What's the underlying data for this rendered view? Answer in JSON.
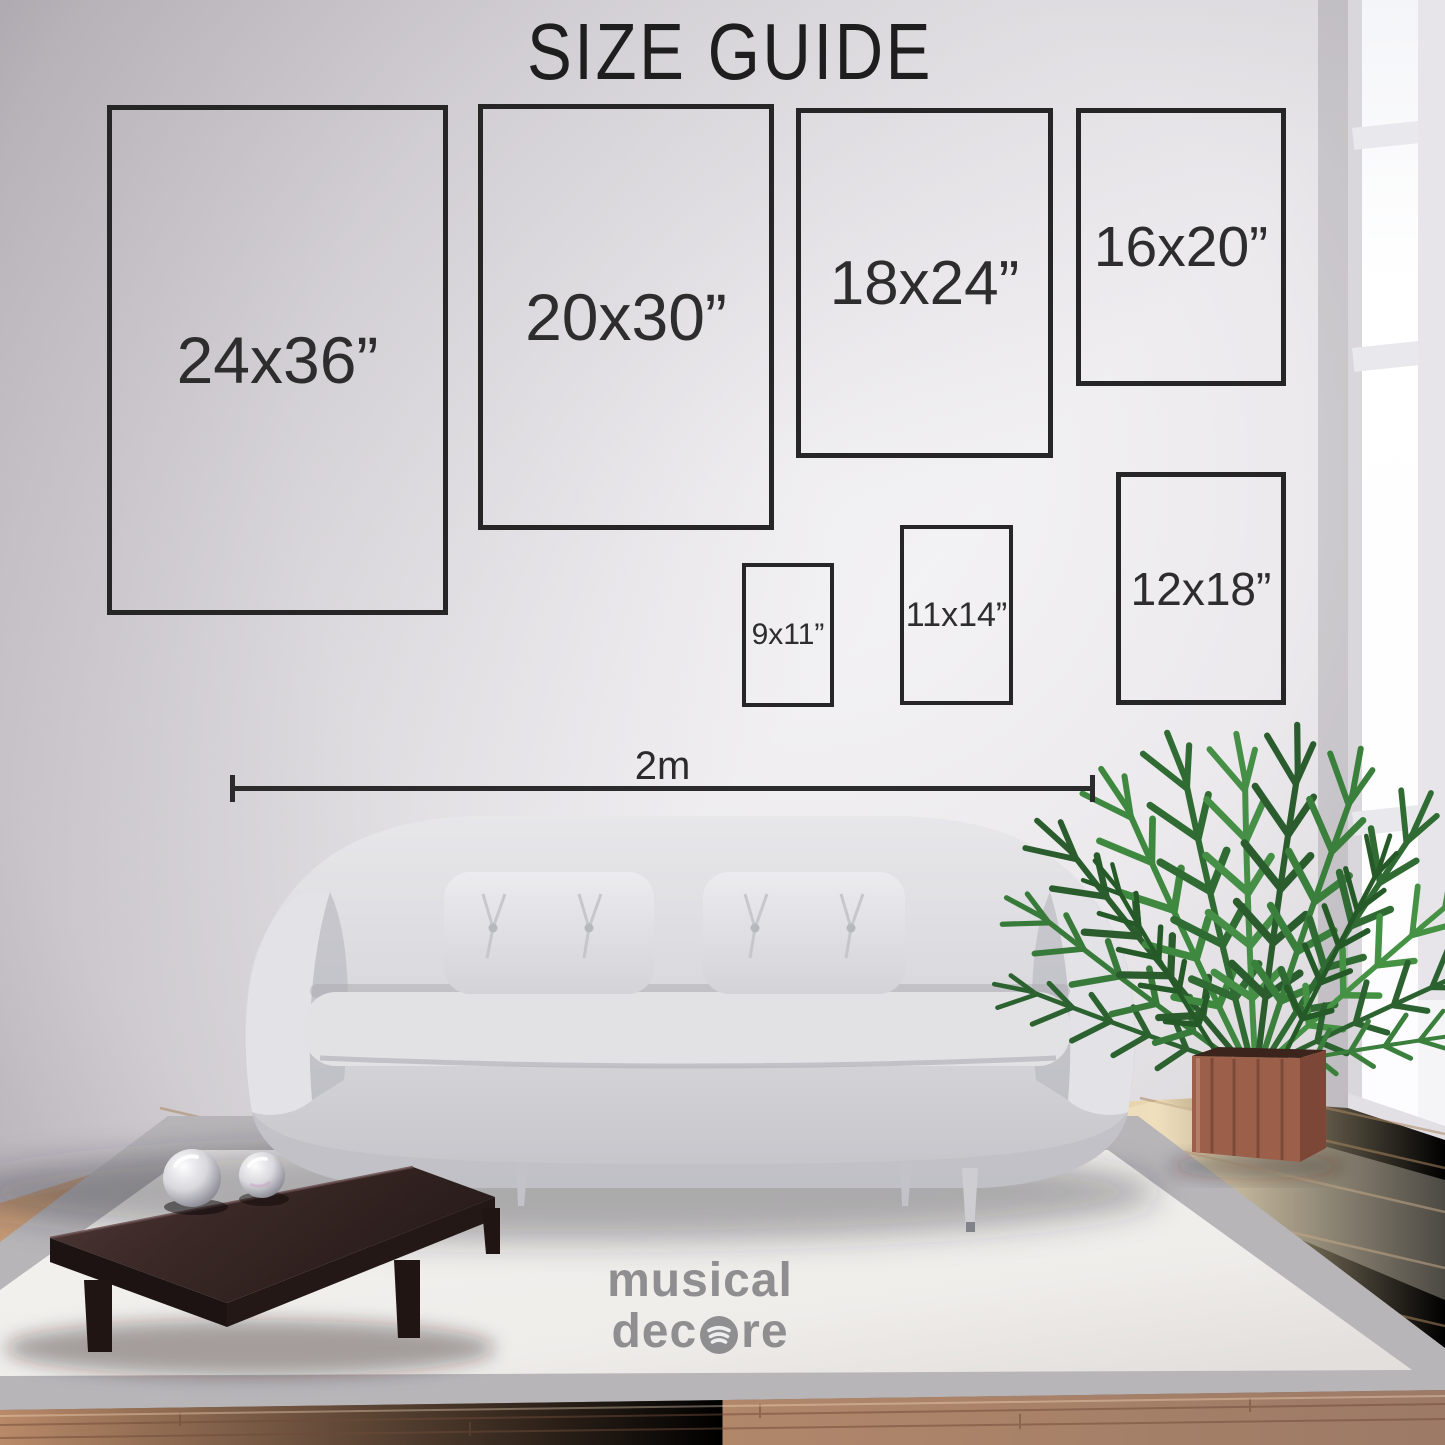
{
  "page": {
    "title": "SIZE GUIDE"
  },
  "size_guide": {
    "boxes": [
      {
        "id": "24x36",
        "label": "24x36”"
      },
      {
        "id": "20x30",
        "label": "20x30”"
      },
      {
        "id": "18x24",
        "label": "18x24”"
      },
      {
        "id": "16x20",
        "label": "16x20”"
      },
      {
        "id": "9x11",
        "label": "9x11”"
      },
      {
        "id": "11x14",
        "label": "11x14”"
      },
      {
        "id": "12x18",
        "label": "12x18”"
      }
    ],
    "measurement_label": "2m"
  },
  "watermark": {
    "line1": "musical",
    "line2_prefix": "dec",
    "line2_suffix": "re",
    "icon": "spotify-style-icon"
  },
  "colors": {
    "box_outline": "#262626",
    "label_text": "#2d2d2d",
    "watermark_gray": "#828285",
    "planter_wood": "#9b5f4a",
    "plant_green": "#3a7f3c",
    "sofa_gray": "#d6d6da",
    "table_wood": "#2f211f"
  }
}
